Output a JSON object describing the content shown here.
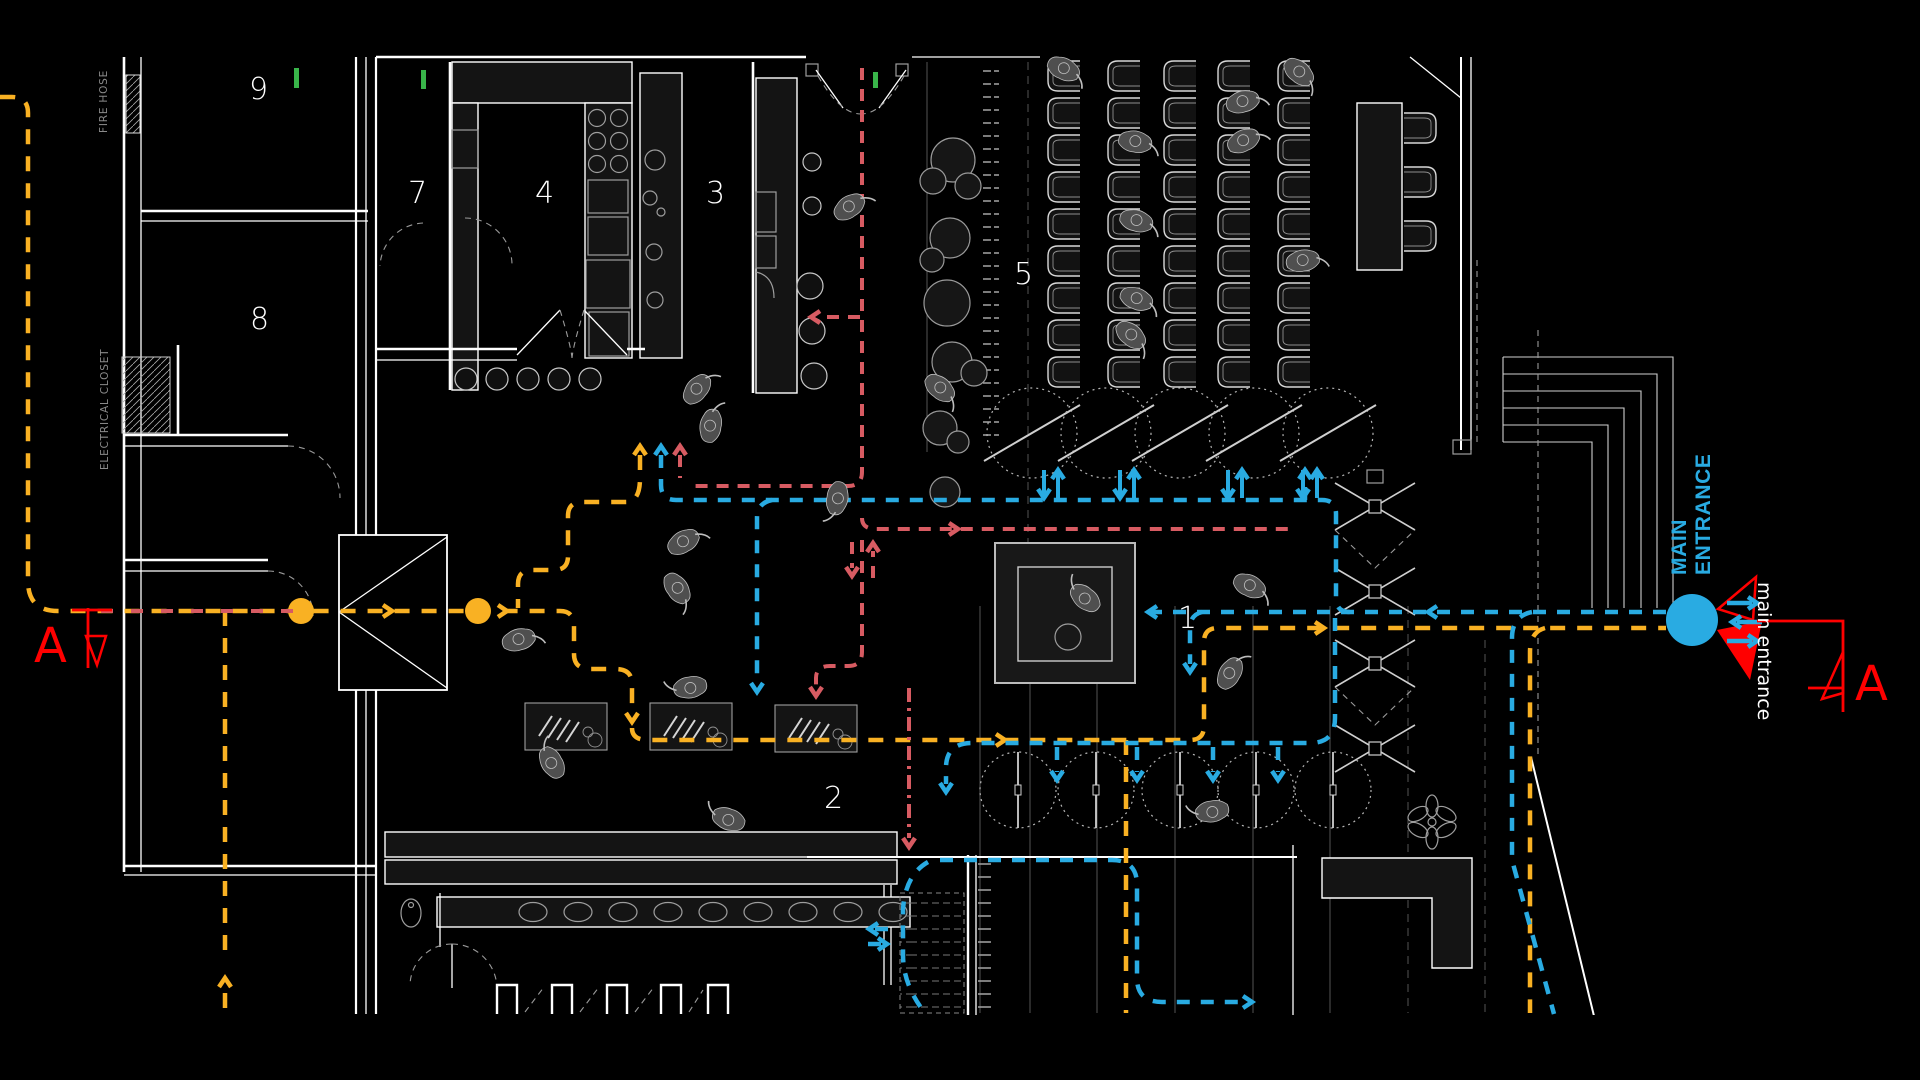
{
  "canvas": {
    "width": 1920,
    "height": 1080,
    "background": "#000000"
  },
  "rooms": {
    "1": "1",
    "2": "2",
    "3": "3",
    "4": "4",
    "5": "5",
    "7": "7",
    "8": "8",
    "9": "9"
  },
  "labels": {
    "fire_hose": "FIRE HOSE",
    "electrical_closet": "ELECTRICAL CLOSET",
    "main_entrance_line1": "MAIN",
    "main_entrance_line2": "ENTRANCE",
    "main_entrance_secondary": "main entrance",
    "section_marker_left": "A",
    "section_marker_right": "A"
  },
  "icons": {
    "entrance_node": "large-cyan-circle",
    "route_node": "yellow-circle",
    "section_cut": "red-triangle-flag",
    "direction_arrow": "chevron-arrowhead"
  },
  "colors": {
    "yellow": "#F9B123",
    "blue": "#29ABE2",
    "redp": "#D75B62",
    "redm": "#FF0000",
    "green": "#39B54A",
    "wall": "#FFFFFF",
    "detail": "#9E9E9E",
    "people": "#4F4F4F",
    "fill-dark": "#141414"
  }
}
